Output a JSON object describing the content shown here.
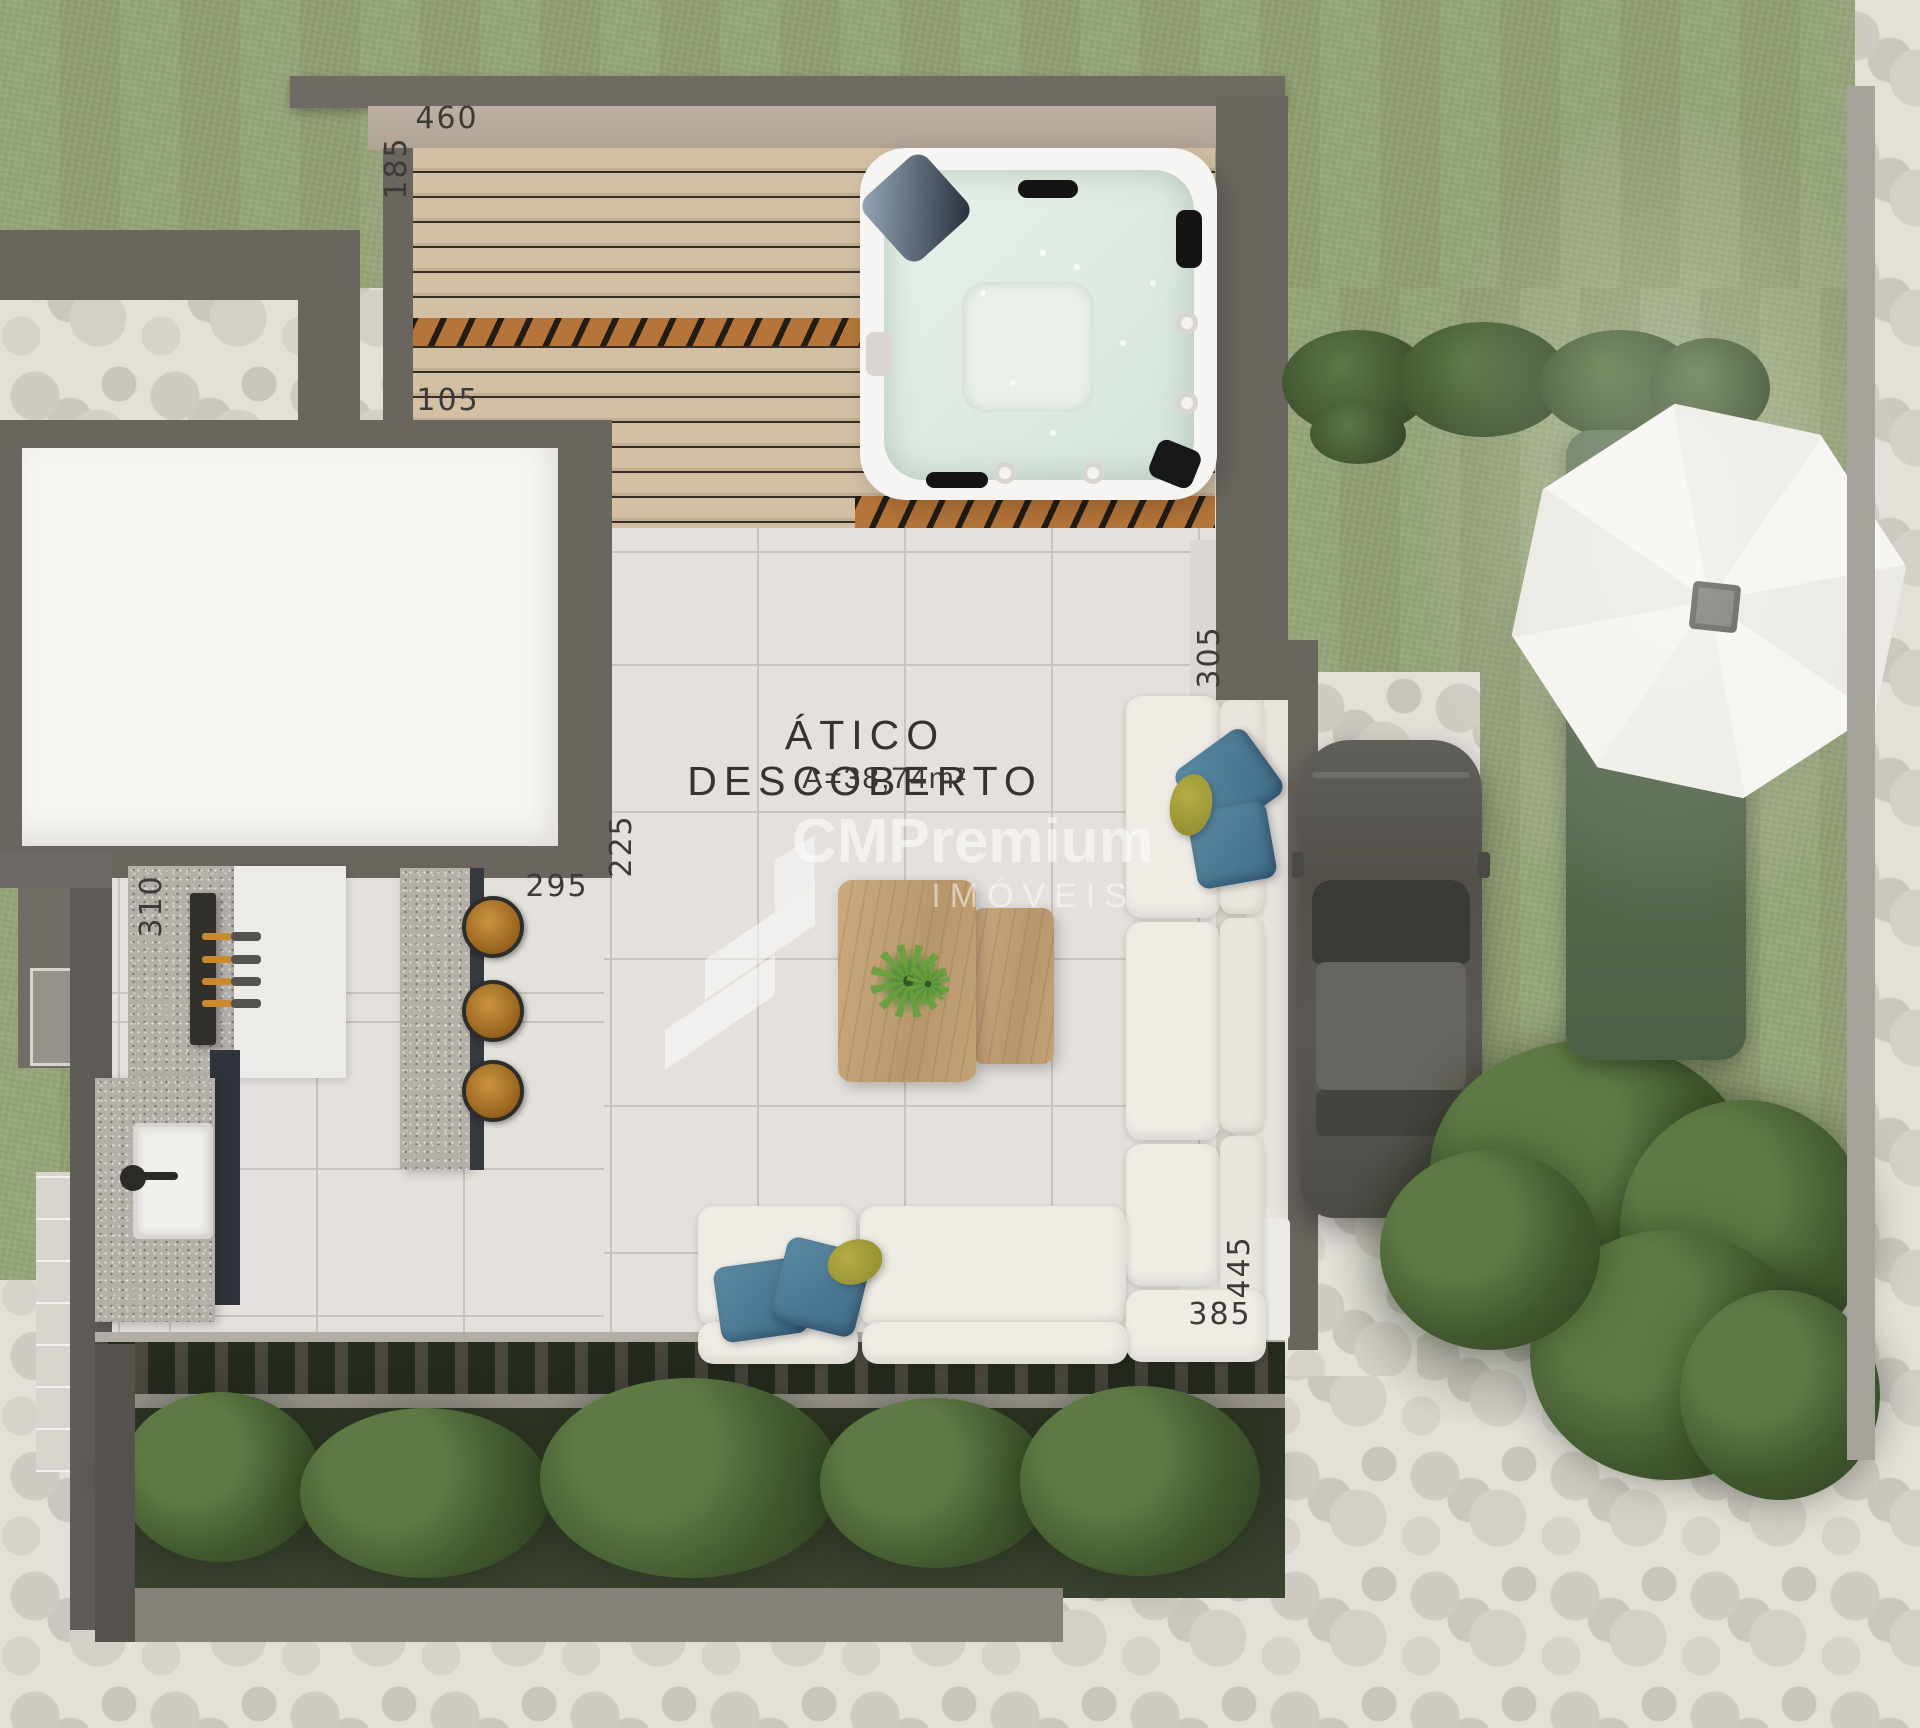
{
  "plan": {
    "room": {
      "title": "ÁTICO DESCOBERTO",
      "area": "A=38,74m²"
    },
    "dims": {
      "roof_width": "460",
      "deck_side": "185",
      "deck_lower": "105",
      "terrace_right_step": "305",
      "terrace_upper_left": "225",
      "kitchen_front": "295",
      "grill_counter_side": "310",
      "sofa_right_side": "445",
      "sofa_bottom": "385"
    }
  },
  "watermark": {
    "brand": "CMPremium",
    "subtitle": "IMÓVEIS"
  },
  "palette": {
    "grass": "#94a277",
    "stone": "#e3e0da",
    "wall": "#6a655f",
    "deck_wood": "#cdbaa0",
    "tile_floor": "#e4e1dc",
    "tub_water": "#dde9e0",
    "sofa": "#efece6",
    "pillow_blue": "#4a7b94",
    "pillow_olive": "#a8a437",
    "table_wood": "#c3a278",
    "granite": "#b4afa8",
    "stool_wood": "#b07a2e",
    "skewer_handle": "#c98a2f",
    "umbrella": "#f4f3ef",
    "lounge_chair": "#5a6f50",
    "car": "#54524d",
    "tree": "#41592f"
  }
}
